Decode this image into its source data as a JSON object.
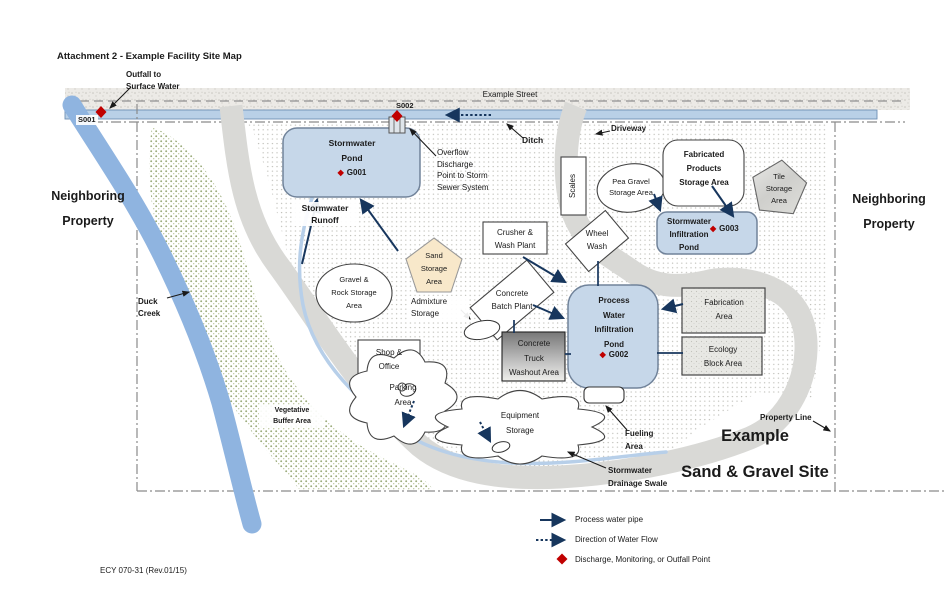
{
  "title": "Attachment 2 - Example Facility Site Map",
  "footer": "ECY 070-31 (Rev.01/15)",
  "street": {
    "name": "Example Street"
  },
  "labels": {
    "outfall": "Outfall to\nSurface Water",
    "s001": "S001",
    "s002": "S002",
    "overflow": "Overflow\nDischarge\nPoint to Storm\nSewer System",
    "ditch": "Ditch",
    "driveway": "Driveway",
    "neighboring_left": "Neighboring\nProperty",
    "neighboring_right": "Neighboring\nProperty",
    "duck_creek": "Duck\nCreek",
    "property_line": "Property Line",
    "site_title": "Example\nSand & Gravel Site",
    "stormwater_runoff": "Stormwater\nRunoff",
    "fueling": "Fueling\nArea",
    "drainage_swale": "Stormwater\nDrainage Swale",
    "vegetative_buffer": "Vegetative\nBuffer Area"
  },
  "areas": {
    "stormwater_pond": {
      "name": "Stormwater\nPond",
      "id": "G001"
    },
    "stormwater_infiltration_pond": {
      "name": "Stormwater\nInfiltration\nPond",
      "id": "G003"
    },
    "process_pond": {
      "name": "Process\nWater\nInfiltration\nPond",
      "id": "G002"
    },
    "scales": "Scales",
    "pea_gravel": "Pea Gravel\nStorage Area",
    "fabricated_products": "Fabricated\nProducts\nStorage Area",
    "tile_storage": "Tile\nStorage\nArea",
    "wheel_wash": "Wheel\nWash",
    "crusher": "Crusher &\nWash Plant",
    "concrete_batch": "Concrete\nBatch Plant",
    "washout": "Concrete\nTruck\nWashout Area",
    "fabrication": "Fabrication\nArea",
    "ecology": "Ecology\nBlock Area",
    "gravel_rock": "Gravel &\nRock Storage\nArea",
    "sand_storage": "Sand\nStorage\nArea",
    "admixture": "Admixture\nStorage",
    "shop_office": "Shop &\nOffice",
    "parking": "Parking\nArea",
    "equipment": "Equipment\nStorage"
  },
  "legend": {
    "items": [
      {
        "label": "Process water pipe"
      },
      {
        "label": "Direction of Water Flow"
      },
      {
        "label": "Discharge, Monitoring, or Outfall Point"
      }
    ]
  },
  "glyphs": {
    "diamond": "◆"
  },
  "colors": {
    "navy": "#17365d",
    "red": "#c00000",
    "pond_fill": "#c6d7e9",
    "road": "#d9d9d6",
    "creek": "#8fb4e0"
  }
}
